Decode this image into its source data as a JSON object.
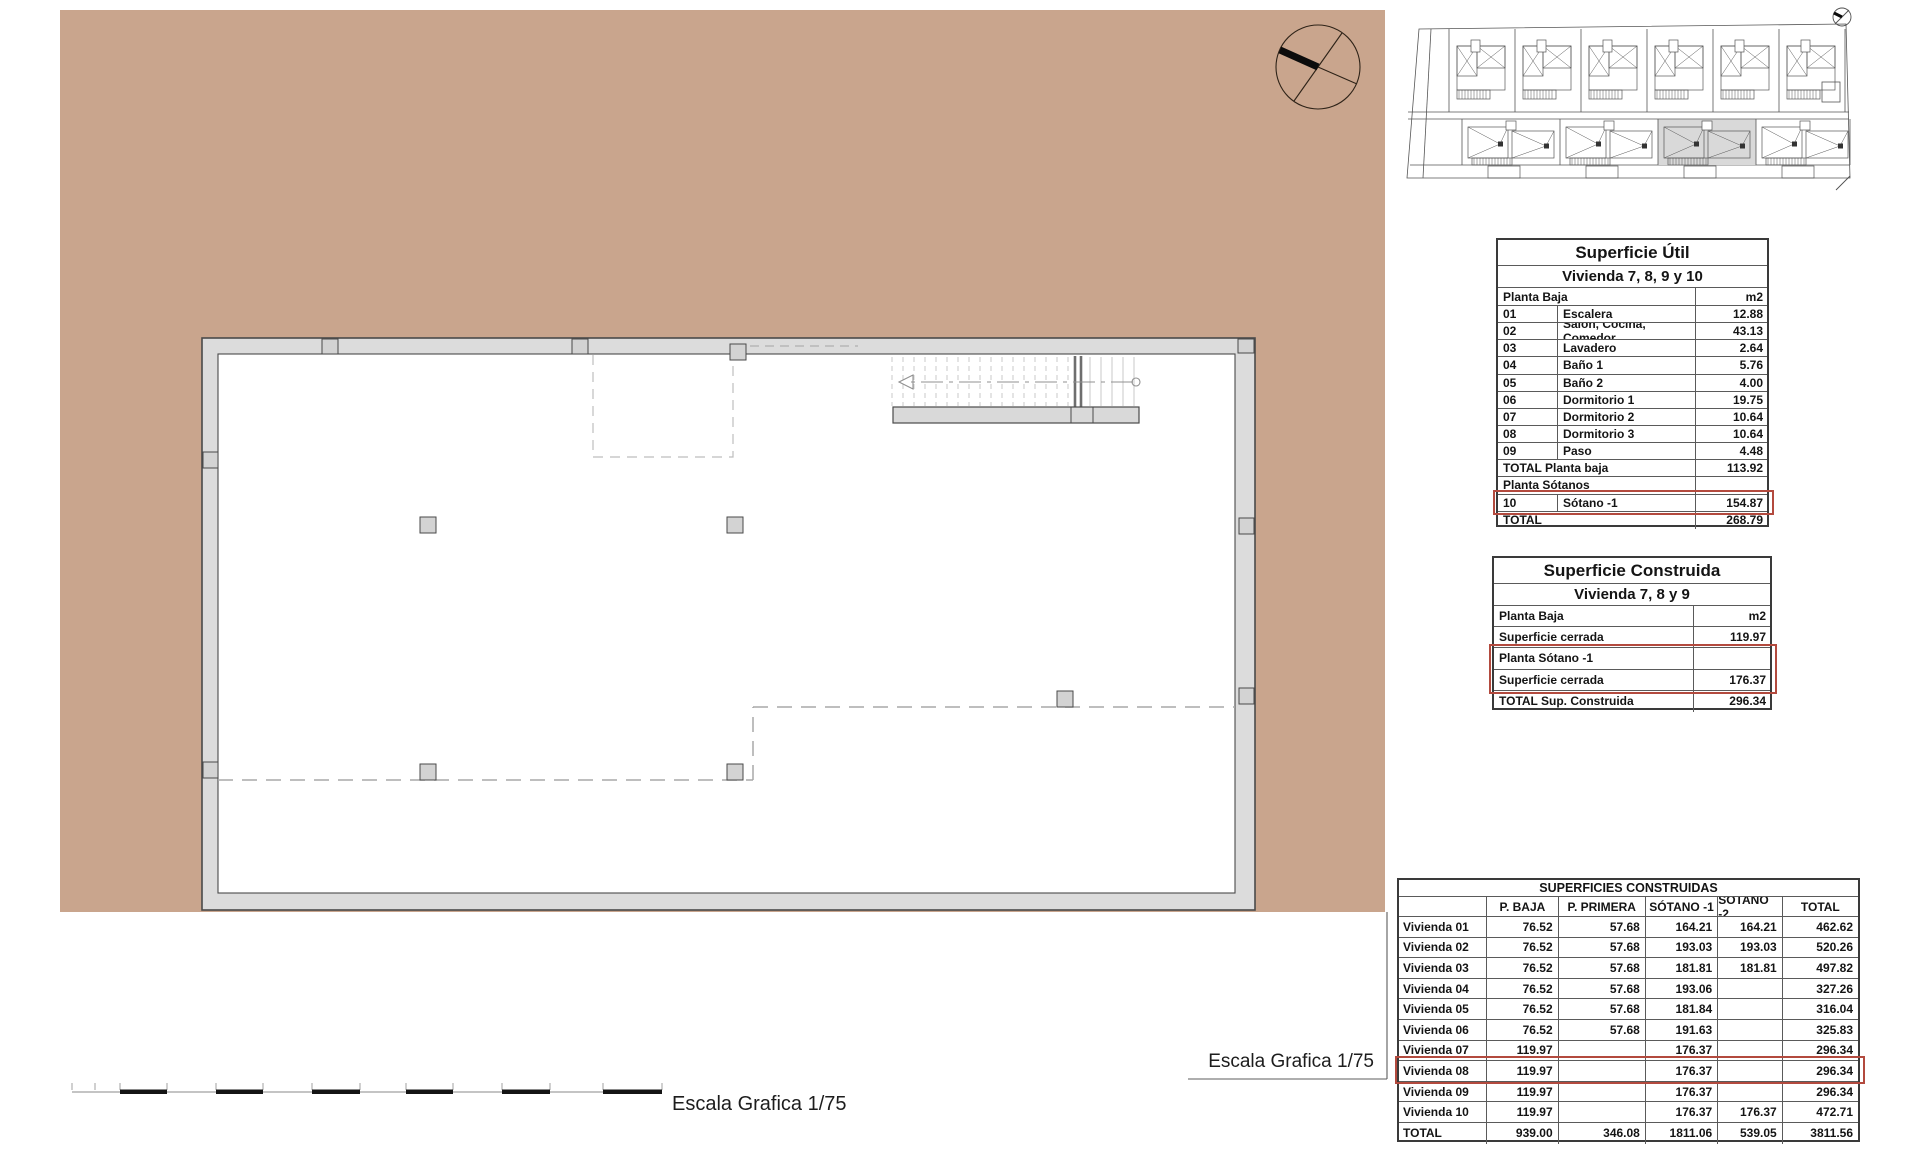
{
  "sheet": {
    "scale_label_plan": "Escala Grafica 1/75",
    "scale_label_bar": "Escala Grafica 1/75"
  },
  "colors": {
    "beige": "#c9a58d",
    "wall_fill": "#dcdcdc",
    "wall_line": "#4a4a4a",
    "highlight_red": "#b34a3e",
    "site_unit_highlight": "#d9d9d9"
  },
  "site_plan": {
    "top_units": 6,
    "bottom_units": 4,
    "highlighted_unit_index": 2
  },
  "tables": {
    "util": {
      "title": "Superficie Útil",
      "subtitle": "Vivienda 7, 8, 9 y 10",
      "header": {
        "label": "Planta Baja",
        "unit": "m2"
      },
      "rows": [
        {
          "type": "r3",
          "num": "01",
          "name": "Escalera",
          "value": "12.88"
        },
        {
          "type": "r3",
          "num": "02",
          "name": "Salón, Cocina, Comedor",
          "value": "43.13"
        },
        {
          "type": "r3",
          "num": "03",
          "name": "Lavadero",
          "value": "2.64"
        },
        {
          "type": "r3",
          "num": "04",
          "name": "Baño 1",
          "value": "5.76"
        },
        {
          "type": "r3",
          "num": "05",
          "name": "Baño 2",
          "value": "4.00"
        },
        {
          "type": "r3",
          "num": "06",
          "name": "Dormitorio 1",
          "value": "19.75"
        },
        {
          "type": "r3",
          "num": "07",
          "name": "Dormitorio 2",
          "value": "10.64"
        },
        {
          "type": "r3",
          "num": "08",
          "name": "Dormitorio 3",
          "value": "10.64"
        },
        {
          "type": "r3",
          "num": "09",
          "name": "Paso",
          "value": "4.48"
        },
        {
          "type": "span",
          "label": "TOTAL Planta baja",
          "value": "113.92"
        },
        {
          "type": "span",
          "label": "Planta Sótanos",
          "value": ""
        },
        {
          "type": "r3",
          "num": "10",
          "name": "Sótano -1",
          "value": "154.87",
          "highlight": true
        },
        {
          "type": "span",
          "label": "TOTAL",
          "value": "268.79"
        }
      ]
    },
    "construida": {
      "title": "Superficie Construida",
      "subtitle": "Vivienda 7, 8 y 9",
      "rows": [
        {
          "label": "Planta Baja",
          "value": "m2"
        },
        {
          "label": "Superficie cerrada",
          "value": "119.97"
        },
        {
          "label": "Planta Sótano -1",
          "value": "",
          "highlight": true
        },
        {
          "label": "Superficie cerrada",
          "value": "176.37",
          "highlight": true
        },
        {
          "label": "TOTAL Sup. Construida",
          "value": "296.34"
        }
      ]
    },
    "resumen": {
      "title": "SUPERFICIES CONSTRUIDAS",
      "columns": [
        "",
        "P. BAJA",
        "P. PRIMERA",
        "SÓTANO -1",
        "SÓTANO -2",
        "TOTAL"
      ],
      "rows": [
        [
          "Vivienda 01",
          "76.52",
          "57.68",
          "164.21",
          "164.21",
          "462.62"
        ],
        [
          "Vivienda 02",
          "76.52",
          "57.68",
          "193.03",
          "193.03",
          "520.26"
        ],
        [
          "Vivienda 03",
          "76.52",
          "57.68",
          "181.81",
          "181.81",
          "497.82"
        ],
        [
          "Vivienda 04",
          "76.52",
          "57.68",
          "193.06",
          "",
          "327.26"
        ],
        [
          "Vivienda 05",
          "76.52",
          "57.68",
          "181.84",
          "",
          "316.04"
        ],
        [
          "Vivienda 06",
          "76.52",
          "57.68",
          "191.63",
          "",
          "325.83"
        ],
        [
          "Vivienda 07",
          "119.97",
          "",
          "176.37",
          "",
          "296.34"
        ],
        [
          "Vivienda 08",
          "119.97",
          "",
          "176.37",
          "",
          "296.34"
        ],
        [
          "Vivienda 09",
          "119.97",
          "",
          "176.37",
          "",
          "296.34"
        ],
        [
          "Vivienda 10",
          "119.97",
          "",
          "176.37",
          "176.37",
          "472.71"
        ],
        [
          "TOTAL",
          "939.00",
          "346.08",
          "1811.06",
          "539.05",
          "3811.56"
        ]
      ],
      "highlighted_row_index": 7
    }
  }
}
